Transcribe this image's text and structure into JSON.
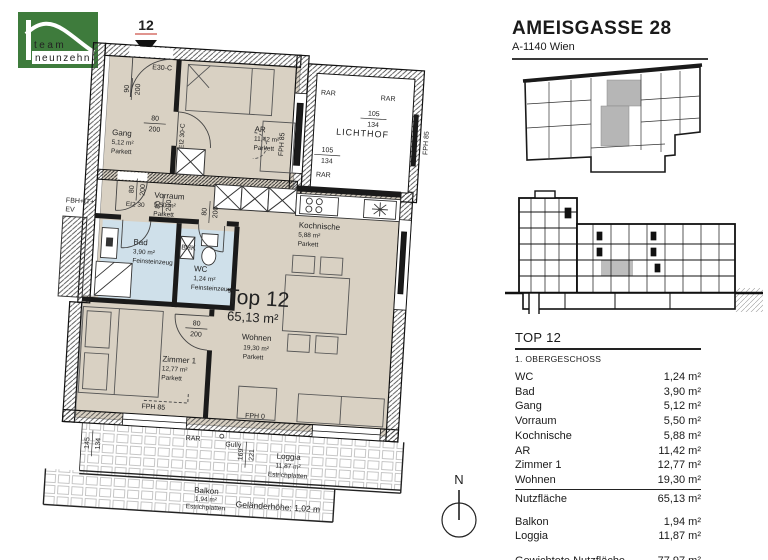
{
  "logo": {
    "team": "team",
    "neunzehn": "neunzehn"
  },
  "header": {
    "title": "AMEISGASSE 28",
    "subtitle": "A-1140 Wien"
  },
  "plan": {
    "marker": "12",
    "unit": {
      "name": "Top 12",
      "area": "65,13 m²"
    },
    "rooms": {
      "gang": {
        "name": "Gang",
        "area": "5,12 m²",
        "floor": "Parkett"
      },
      "ar": {
        "name": "AR",
        "area": "11,42 m²",
        "floor": "Parkett"
      },
      "lichthof": {
        "name": "LICHTHOF"
      },
      "vorraum": {
        "name": "Vorraum",
        "area": "5,50 m²",
        "floor": "Parkett"
      },
      "kochnische": {
        "name": "Kochnische",
        "area": "5,88 m²",
        "floor": "Parkett"
      },
      "bad": {
        "name": "Bad",
        "area": "3,90 m²",
        "floor": "Feinsteinzeug"
      },
      "wc": {
        "name": "WC",
        "area": "1,24 m²",
        "floor": "Feinsteinzeug"
      },
      "wohnen": {
        "name": "Wohnen",
        "area": "19,30 m²",
        "floor": "Parkett"
      },
      "zimmer1": {
        "name": "Zimmer 1",
        "area": "12,77 m²",
        "floor": "Parkett"
      },
      "loggia": {
        "name": "Loggia",
        "area": "11,87 m²",
        "floor": "Estrichplatten"
      },
      "balkon": {
        "name": "Balkon",
        "area": "1,94 m²",
        "floor": "Estrichplatten"
      }
    },
    "labels": {
      "e30c": "E30-C",
      "ei230c": "EI2 30-C",
      "ei230": "EI2 30",
      "fbh": "FBH+IT+",
      "ev": "EV",
      "bhk": "BHK",
      "fph85": "FPH 85",
      "fph0": "FPH 0",
      "rar": "RAR",
      "gully": "Gully",
      "railing": "Geländerhöhe: 1,02 m"
    },
    "dims": {
      "entry": {
        "t": "90",
        "b": "200"
      },
      "d80": {
        "t": "80",
        "b": "200"
      },
      "w105": {
        "t": "105",
        "b": "134"
      },
      "w145": {
        "t": "145",
        "b": "134"
      },
      "w169": {
        "t": "169",
        "b": "221"
      }
    }
  },
  "compass": {
    "label": "N"
  },
  "table": {
    "title": "TOP 12",
    "storey": "1. OBERGESCHOSS",
    "rows": [
      {
        "label": "WC",
        "value": "1,24 m²"
      },
      {
        "label": "Bad",
        "value": "3,90 m²"
      },
      {
        "label": "Gang",
        "value": "5,12 m²"
      },
      {
        "label": "Vorraum",
        "value": "5,50 m²"
      },
      {
        "label": "Kochnische",
        "value": "5,88 m²"
      },
      {
        "label": "AR",
        "value": "11,42 m²"
      },
      {
        "label": "Zimmer 1",
        "value": "12,77 m²"
      },
      {
        "label": "Wohnen",
        "value": "19,30 m²"
      }
    ],
    "subtotal": {
      "label": "Nutzfläche",
      "value": "65,13 m²"
    },
    "outdoor": [
      {
        "label": "Balkon",
        "value": "1,94 m²"
      },
      {
        "label": "Loggia",
        "value": "11,87 m²"
      }
    ],
    "total": {
      "label": "Gewichtete Nutzfläche",
      "value": "77,97 m²"
    }
  }
}
